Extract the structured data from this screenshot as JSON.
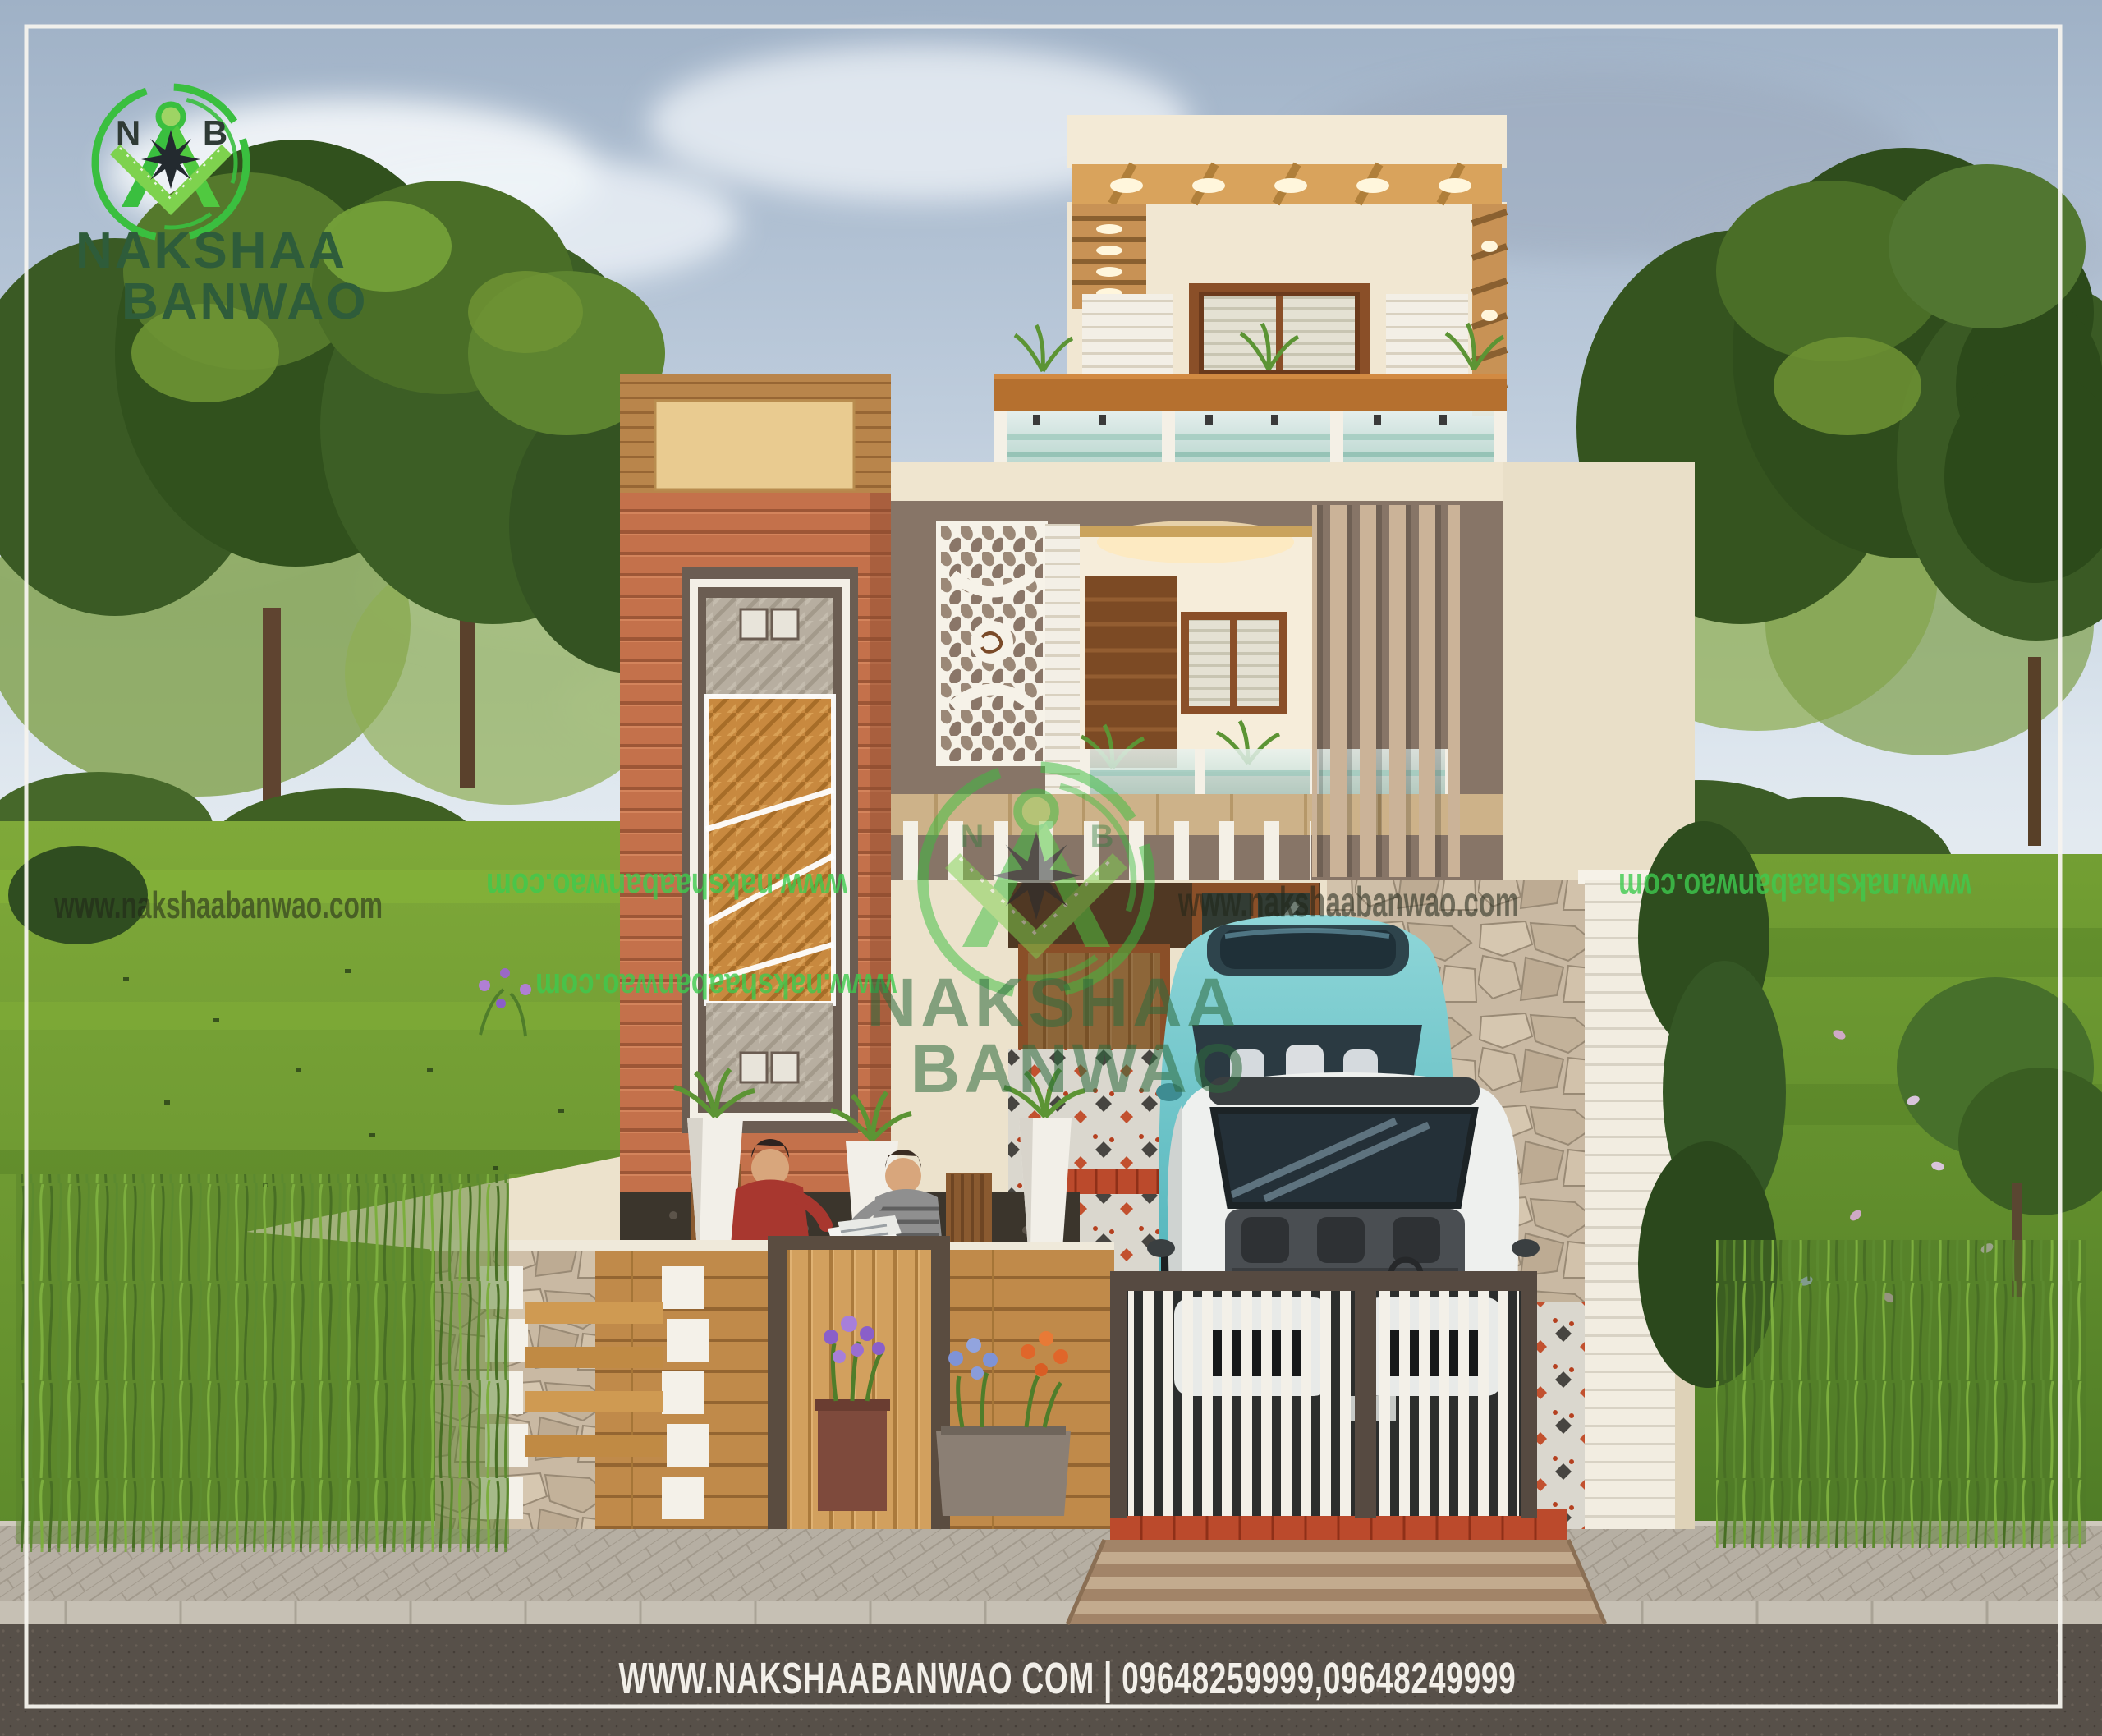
{
  "brand": {
    "monogram_left": "N",
    "monogram_right": "B",
    "name_line1": "NAKSHAA",
    "name_line2": "BANWAO"
  },
  "watermark": {
    "url": "www.nakshaabanwao.com",
    "instances": [
      {
        "placement": "left-lawn",
        "style": "dark",
        "mirrored": false
      },
      {
        "placement": "center-left-lawn",
        "style": "green",
        "mirrored": true
      },
      {
        "placement": "left-tower",
        "style": "green",
        "mirrored": true
      },
      {
        "placement": "center-house",
        "style": "dark",
        "mirrored": false
      },
      {
        "placement": "right-lawn",
        "style": "green",
        "mirrored": true
      },
      {
        "placement": "center-logo-stamp",
        "style": "green-logo",
        "mirrored": false
      }
    ]
  },
  "footer": {
    "text": "WWW.NAKSHAABANWAO COM | 09648259999,09648249999"
  },
  "palette": {
    "brand-green": "#3abf3f",
    "brand-dark": "#2e5c3a",
    "wm-green": "#3ecb4e",
    "ink": "#1f2518",
    "cream": "#f1e7d2",
    "cream-shade": "#e2d6bd",
    "white-trim": "#f4f1e8",
    "taupe": "#877567",
    "taupe-dark": "#6e5f53",
    "terracotta": "#c4714b",
    "wood-dark": "#6b3a1c",
    "beam": "#b5702f",
    "frame-dark": "#5a4c40",
    "brick-white": "#f2ede1",
    "gate-white": "#f3f0e8",
    "red-tile": "#bb4a2c",
    "car-teal": "#76c9cd",
    "car-white": "#eef0ee",
    "road": "#575049",
    "paver": "#b9b2a7",
    "lawn": "#6d9a30",
    "tree-dark": "#314d1e",
    "sky-top": "#9fb1c6"
  }
}
